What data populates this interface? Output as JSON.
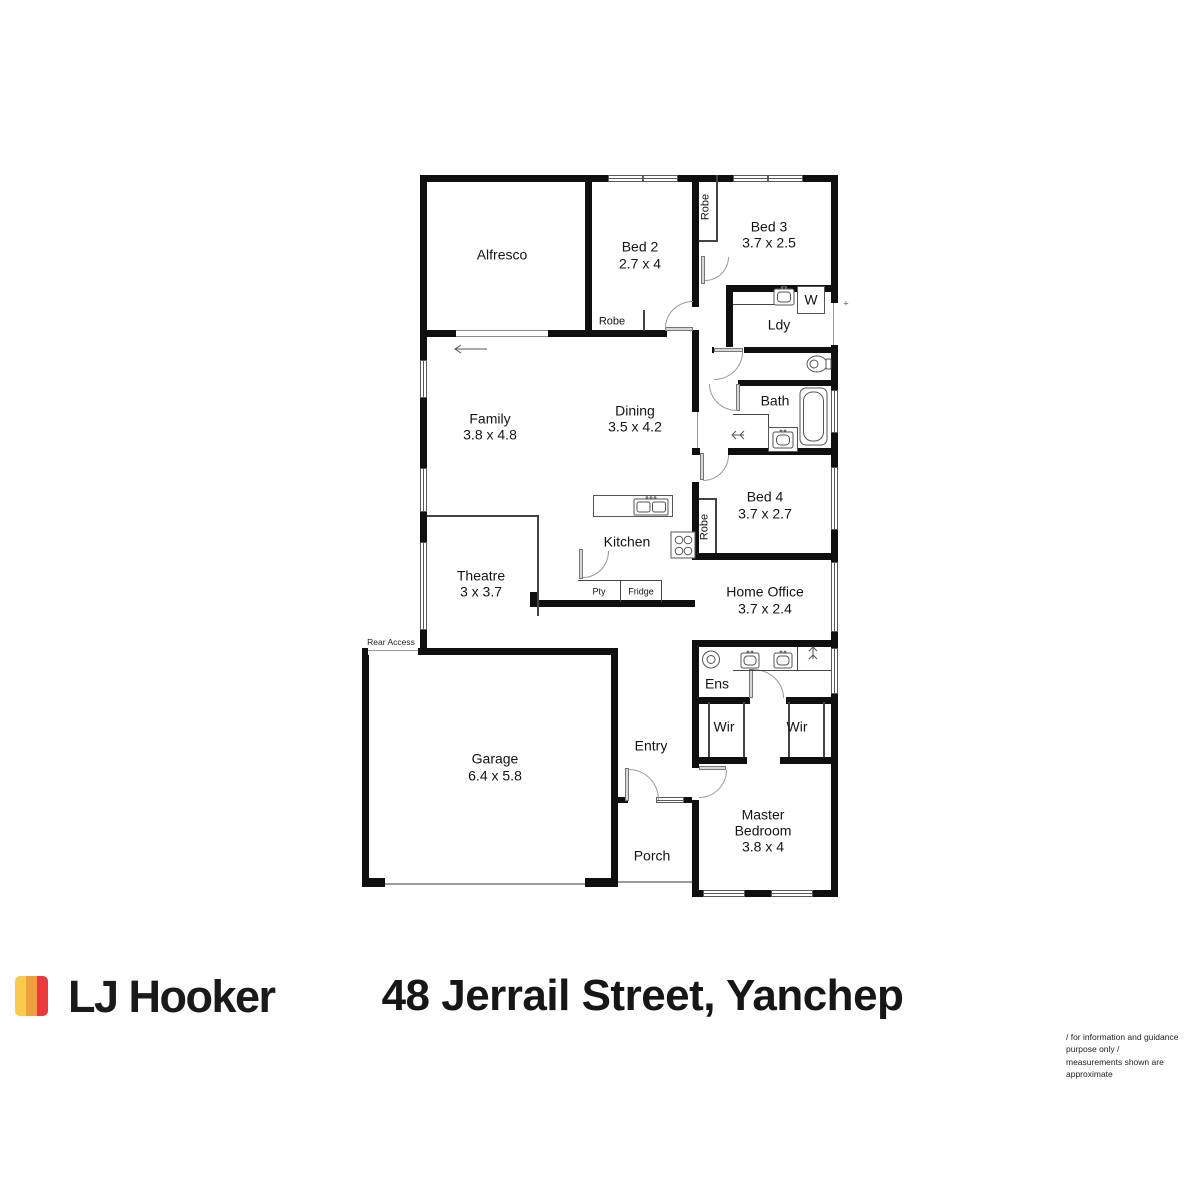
{
  "branding": {
    "agency": "LJ Hooker",
    "logo_colors": {
      "yellow": "#FBCA4C",
      "orange": "#EFA13E",
      "red": "#E93A3C"
    }
  },
  "address": "48 Jerrail Street, Yanchep",
  "disclaimer": {
    "line1": "/ for information and guidance purpose only /",
    "line2": "measurements shown are approximate"
  },
  "rooms": {
    "alfresco": {
      "name": "Alfresco"
    },
    "bed2": {
      "name": "Bed 2",
      "dims": "2.7 x 4"
    },
    "bed3": {
      "name": "Bed 3",
      "dims": "3.7 x 2.5"
    },
    "ldy": {
      "name": "Ldy"
    },
    "bath": {
      "name": "Bath"
    },
    "family": {
      "name": "Family",
      "dims": "3.8 x 4.8"
    },
    "dining": {
      "name": "Dining",
      "dims": "3.5 x 4.2"
    },
    "kitchen": {
      "name": "Kitchen"
    },
    "bed4": {
      "name": "Bed 4",
      "dims": "3.7 x 2.7"
    },
    "theatre": {
      "name": "Theatre",
      "dims": "3 x 3.7"
    },
    "home_office": {
      "name": "Home Office",
      "dims": "3.7 x 2.4"
    },
    "ens": {
      "name": "Ens"
    },
    "wir_left": {
      "name": "Wir"
    },
    "wir_right": {
      "name": "Wir"
    },
    "master": {
      "line1": "Master",
      "line2": "Bedroom",
      "dims": "3.8 x 4"
    },
    "garage": {
      "name": "Garage",
      "dims": "6.4 x 5.8"
    },
    "entry": {
      "name": "Entry"
    },
    "porch": {
      "name": "Porch"
    }
  },
  "annotations": {
    "robe_bed2": "Robe",
    "robe_bed3": "Robe",
    "robe_bed4": "Robe",
    "pty": "Pty",
    "fridge": "Fridge",
    "washer": "W",
    "rear_access": "Rear Access",
    "exterior_door_mark": "+"
  }
}
